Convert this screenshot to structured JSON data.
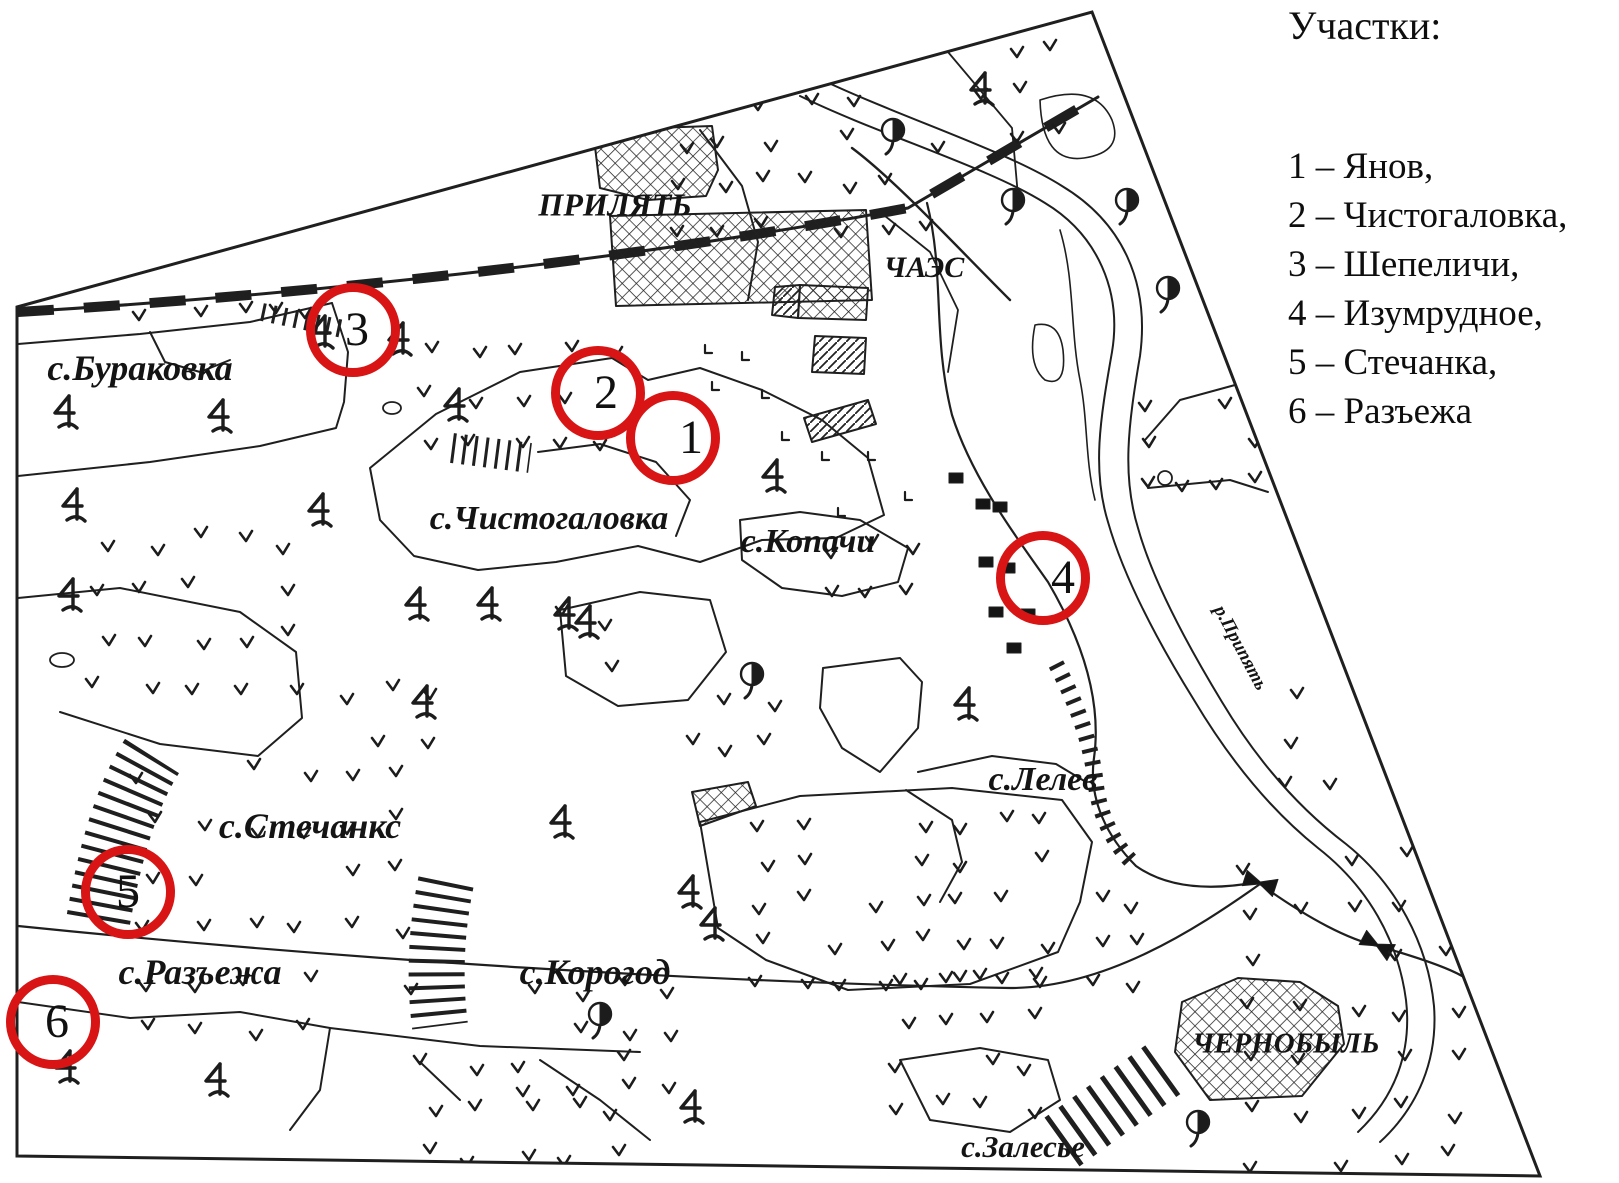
{
  "figure": {
    "background": "#ffffff",
    "line_color": "#1f1f1f"
  },
  "legend": {
    "title": "Участки:",
    "separator": "–",
    "items": [
      {
        "number": "1",
        "name": "Янов,"
      },
      {
        "number": "2",
        "name": "Чистогаловка,"
      },
      {
        "number": "3",
        "name": "Шепеличи,"
      },
      {
        "number": "4",
        "name": "Изумрудное,"
      },
      {
        "number": "5",
        "name": "Стечанка,"
      },
      {
        "number": "6",
        "name": "Разъежа"
      }
    ]
  },
  "map": {
    "marker_color": "#d81414",
    "marker_radius": 47,
    "marker_ring_width": 9,
    "site_markers": [
      {
        "number": "1",
        "x": 673,
        "y": 438,
        "dx": 18
      },
      {
        "number": "2",
        "x": 598,
        "y": 393,
        "dx": 8
      },
      {
        "number": "3",
        "x": 353,
        "y": 330,
        "dx": 4
      },
      {
        "number": "4",
        "x": 1043,
        "y": 578,
        "dx": 20
      },
      {
        "number": "5",
        "x": 128,
        "y": 892,
        "dx": 0
      },
      {
        "number": "6",
        "x": 53,
        "y": 1022,
        "dx": 4
      }
    ],
    "place_labels": [
      {
        "id": "pripyat-town",
        "text": "ПРИЛЯТЬ",
        "x": 615,
        "y": 205,
        "size": 32,
        "rotate": 0
      },
      {
        "id": "chaes",
        "text": "ЧАЭС",
        "x": 924,
        "y": 268,
        "size": 30,
        "rotate": 0
      },
      {
        "id": "burakovka",
        "text": "с.Бураковка",
        "x": 140,
        "y": 368,
        "size": 36,
        "rotate": 0
      },
      {
        "id": "chistogalovka",
        "text": "с.Чистогаловка",
        "x": 549,
        "y": 519,
        "size": 34,
        "rotate": 0
      },
      {
        "id": "kopachi",
        "text": "с.Копачи",
        "x": 808,
        "y": 542,
        "size": 34,
        "rotate": 0
      },
      {
        "id": "lelev",
        "text": "с.Лелев",
        "x": 1043,
        "y": 780,
        "size": 34,
        "rotate": 0
      },
      {
        "id": "stechanks",
        "text": "с.Стечанкс",
        "x": 310,
        "y": 826,
        "size": 36,
        "rotate": 0
      },
      {
        "id": "razyezha",
        "text": "с.Разъежа",
        "x": 200,
        "y": 972,
        "size": 36,
        "rotate": 0
      },
      {
        "id": "korogod",
        "text": "с.Корогод",
        "x": 595,
        "y": 972,
        "size": 36,
        "rotate": 0
      },
      {
        "id": "chernobyl-town",
        "text": "ЧЕРНОБЫЛЬ",
        "x": 1286,
        "y": 1044,
        "size": 29,
        "rotate": 0
      },
      {
        "id": "zalesye",
        "text": "с.Залесье",
        "x": 1023,
        "y": 1147,
        "size": 31,
        "rotate": 0
      },
      {
        "id": "pripyat-river",
        "text": "р.Припять",
        "x": 1240,
        "y": 648,
        "size": 19,
        "rotate": 62
      }
    ]
  },
  "icons": {
    "tree": "tree-icon",
    "orchard": "orchard-icon",
    "meadow": "meadow-grass-icon",
    "building": "building-icon",
    "bridge": "bridge-crossing-icon",
    "corner": "corner-mark-icon"
  }
}
